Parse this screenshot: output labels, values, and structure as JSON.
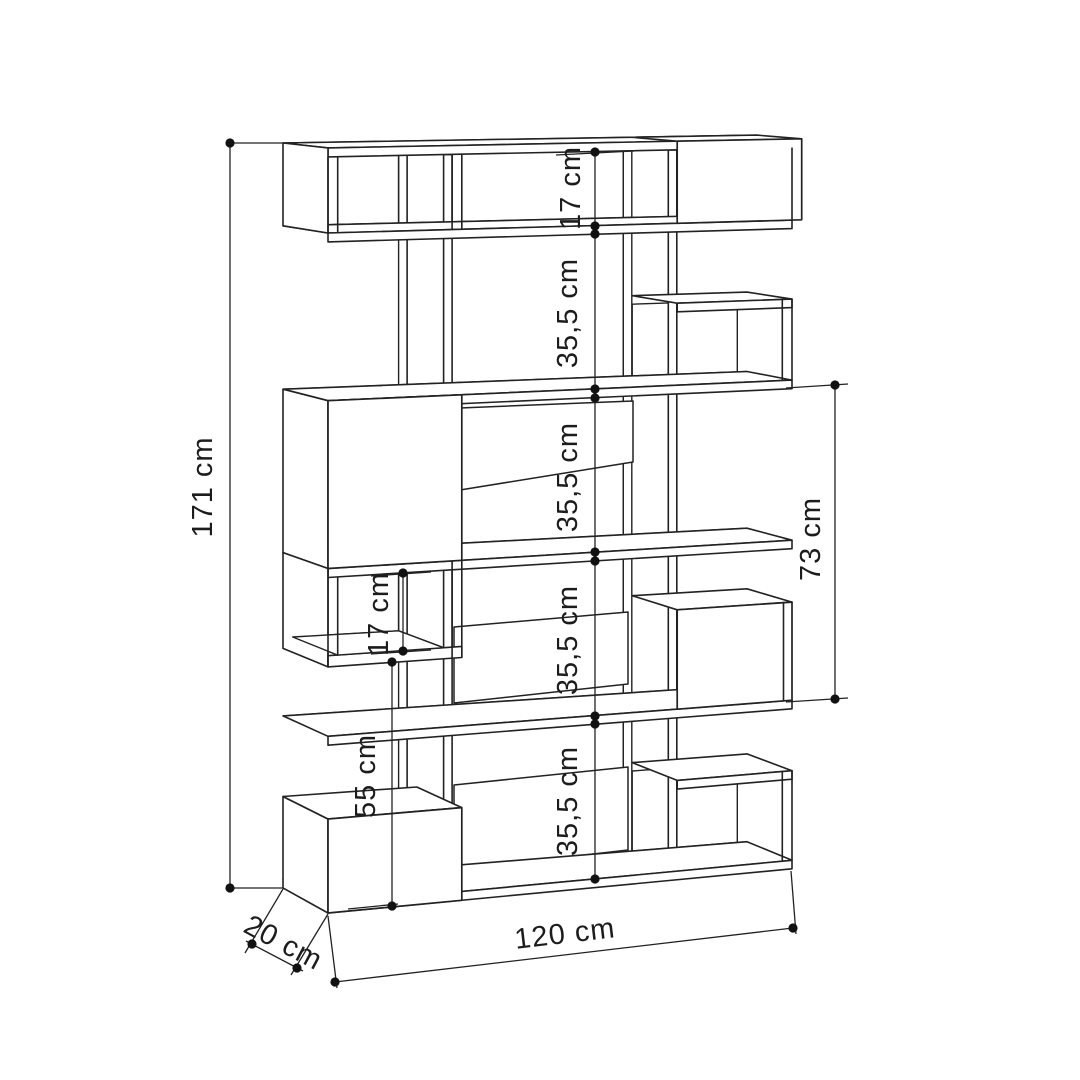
{
  "drawing": {
    "object": "bookcase-dimension-diagram",
    "background": "#ffffff",
    "line_color": "#222222",
    "overall": {
      "height": "171 cm",
      "width": "120 cm",
      "depth": "20 cm"
    },
    "annotations": {
      "total_height": "171 cm",
      "row1_interior": "17 cm",
      "row2_interior": "35,5 cm",
      "row3_interior": "35,5 cm",
      "row4_interior": "35,5 cm",
      "row5_interior": "35,5 cm",
      "right_span": "73 cm",
      "left_box_interior": "17 cm",
      "left_box_clearance": "55 cm",
      "total_width": "120 cm",
      "total_depth": "20 cm"
    }
  }
}
